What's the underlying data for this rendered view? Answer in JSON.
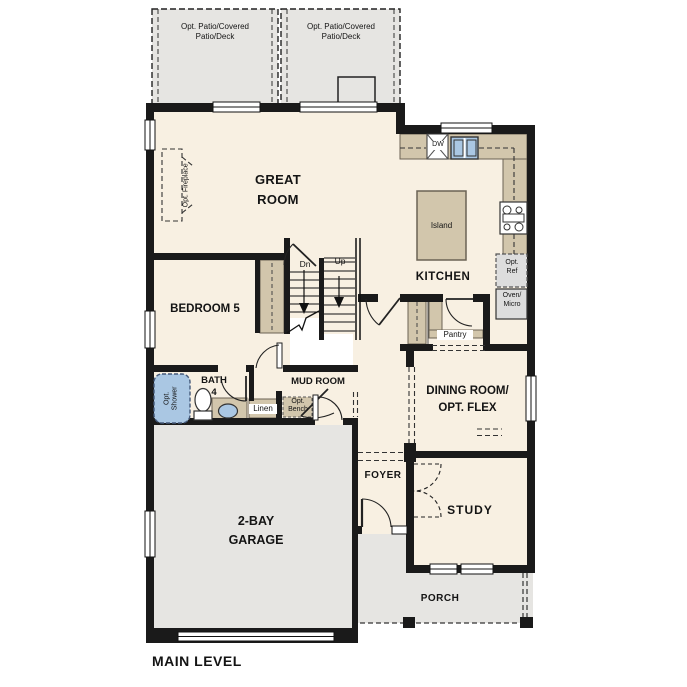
{
  "title": "MAIN LEVEL",
  "rooms": {
    "patio_left": "Opt. Patio/Covered\nPatio/Deck",
    "patio_right": "Opt. Patio/Covered\nPatio/Deck",
    "great_room": "GREAT\nROOM",
    "kitchen": "KITCHEN",
    "bedroom_5": "BEDROOM 5",
    "bath_4": "BATH\n4",
    "mud_room": "MUD ROOM",
    "dining_room": "DINING ROOM/\nOPT. FLEX",
    "foyer": "FOYER",
    "study": "STUDY",
    "garage": "2-BAY\nGARAGE",
    "porch": "PORCH"
  },
  "features": {
    "opt_fireplace": "Opt. Fireplace",
    "opt_shower": "Opt.\nShower",
    "island": "Island",
    "dishwasher": "DW",
    "opt_ref": "Opt.\nRef",
    "oven_micro": "Oven/\nMicro",
    "pantry": "Pantry",
    "linen": "Linen",
    "opt_bench": "Opt.\nBench",
    "stairs_down": "Dn",
    "stairs_up": "Up"
  },
  "colors": {
    "wall": "#1a1a1a",
    "floor": "#f8f0e2",
    "outdoor": "#e6e5e2",
    "cabinet": "#d2c6ac",
    "plumbing": "#aac7e3",
    "appliance": "#dddddd"
  }
}
